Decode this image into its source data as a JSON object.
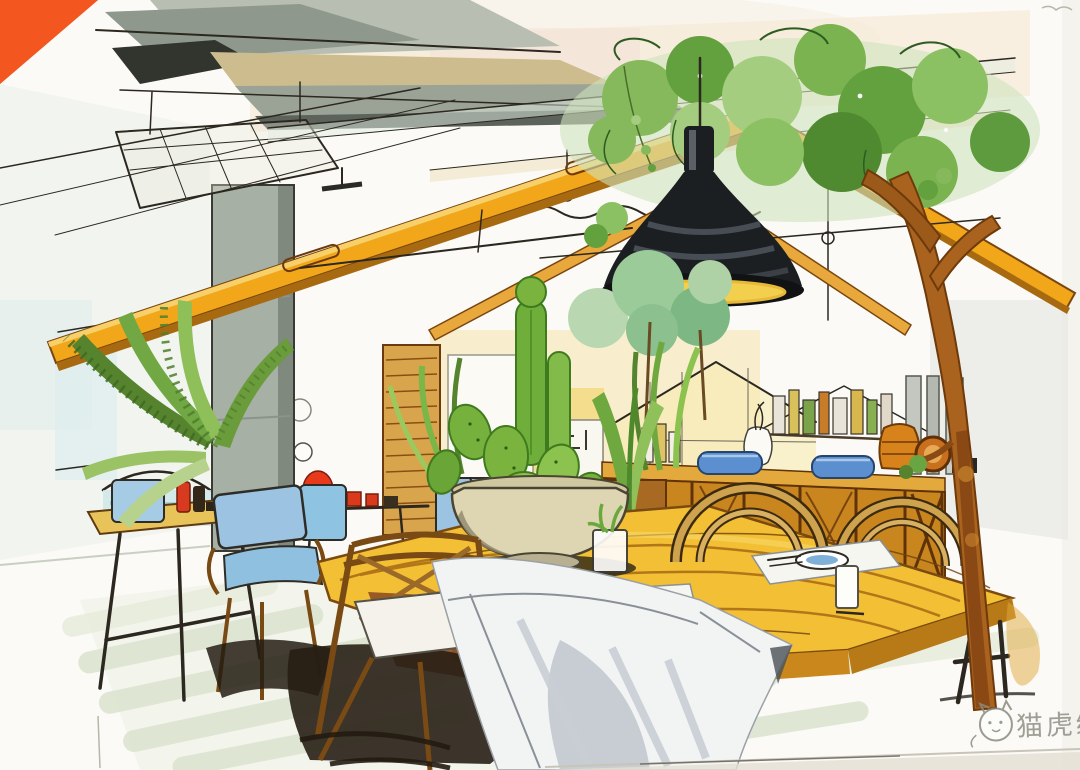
{
  "watermark": {
    "logo": "cat-face-logo",
    "text": "猫虎绘"
  },
  "palette": {
    "backdrop-orange": "#f3571f",
    "paper-white": "#fbfaf6",
    "timber-amber": "#f2a71b",
    "table-yellow": "#f2bf35",
    "wood-brown": "#b5782e",
    "foliage-green": "#6fae3a",
    "foliage-teal": "#9ccb9a",
    "cushion-blue": "#9cc4e2",
    "dish-blue": "#5b8fd0",
    "accent-red": "#d93a1c",
    "lamp-black": "#1c1f22",
    "concrete-gray": "#a7b0a4",
    "floor-green": "#dbe4cf",
    "cloth-white": "#f2f4f4"
  }
}
